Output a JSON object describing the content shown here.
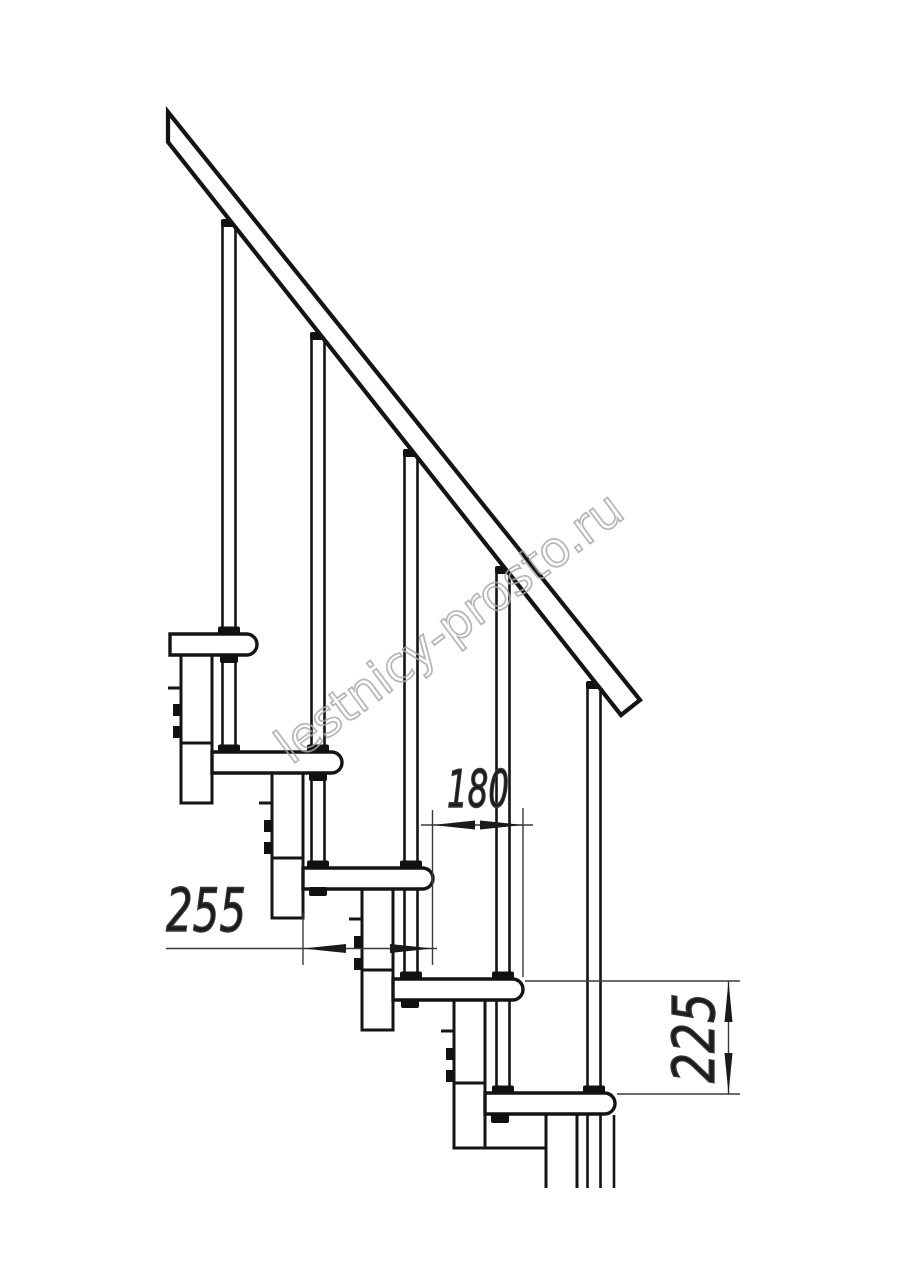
{
  "drawing": {
    "title": "staircase side view technical drawing",
    "watermark": "lestnicy-prosto.ru",
    "dimensions": {
      "step_depth": {
        "value": "255",
        "orientation": "horizontal"
      },
      "step_going": {
        "value": "180",
        "orientation": "horizontal"
      },
      "step_rise": {
        "value": "225",
        "orientation": "vertical"
      }
    },
    "counts": {
      "treads": 5,
      "balusters": 5,
      "support_columns": 5
    },
    "colors": {
      "line": "#141414",
      "dimension_line": "#3a3a3a",
      "dimension_text": "#1c1c1c",
      "watermark": "#a9a9a9",
      "background": "#ffffff"
    }
  }
}
